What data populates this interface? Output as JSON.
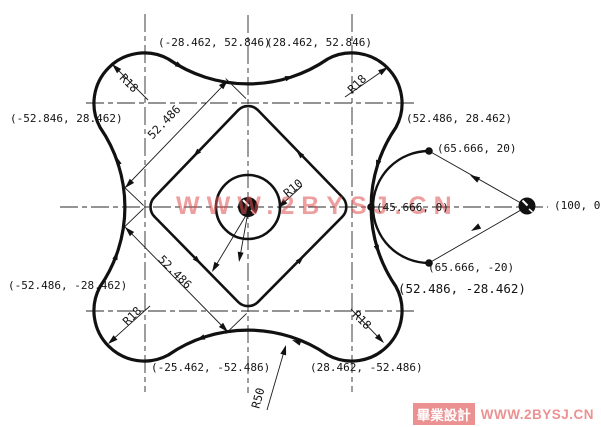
{
  "page": {
    "background": "#ffffff",
    "ink": "#141414",
    "watermark_color": "#e04f4f",
    "footer_pink": "#ec9191"
  },
  "coordinate_labels": {
    "top_left": "(-28.462, 52.846)",
    "top_right": "(28.462, 52.846)",
    "left_upper": "(-52.846, 28.462)",
    "right_upper": "(52.486, 28.462)",
    "left_lower": "(-52.486, -28.462)",
    "right_lower": "(52.486, -28.462)",
    "bottom_left": "(-25.462, -52.486)",
    "bottom_right": "(28.462, -52.486)",
    "aux_circle_top": "(65.666, 20)",
    "aux_circle_bottom": "(65.666, -20)",
    "aux_circle_left": "(45.666, 0)",
    "aux_point_right": "(100, 0)"
  },
  "radius_labels": {
    "lobe": "R18",
    "bore": "R10",
    "flank": "R50"
  },
  "dimension_labels": {
    "upper_edge": "52.486",
    "lower_edge": "52.486"
  },
  "watermarks": {
    "center": "WWW.2BYSJ.CN",
    "footer_badge": "畢業設計",
    "footer_site": "WWW.2BYSJ.CN"
  }
}
